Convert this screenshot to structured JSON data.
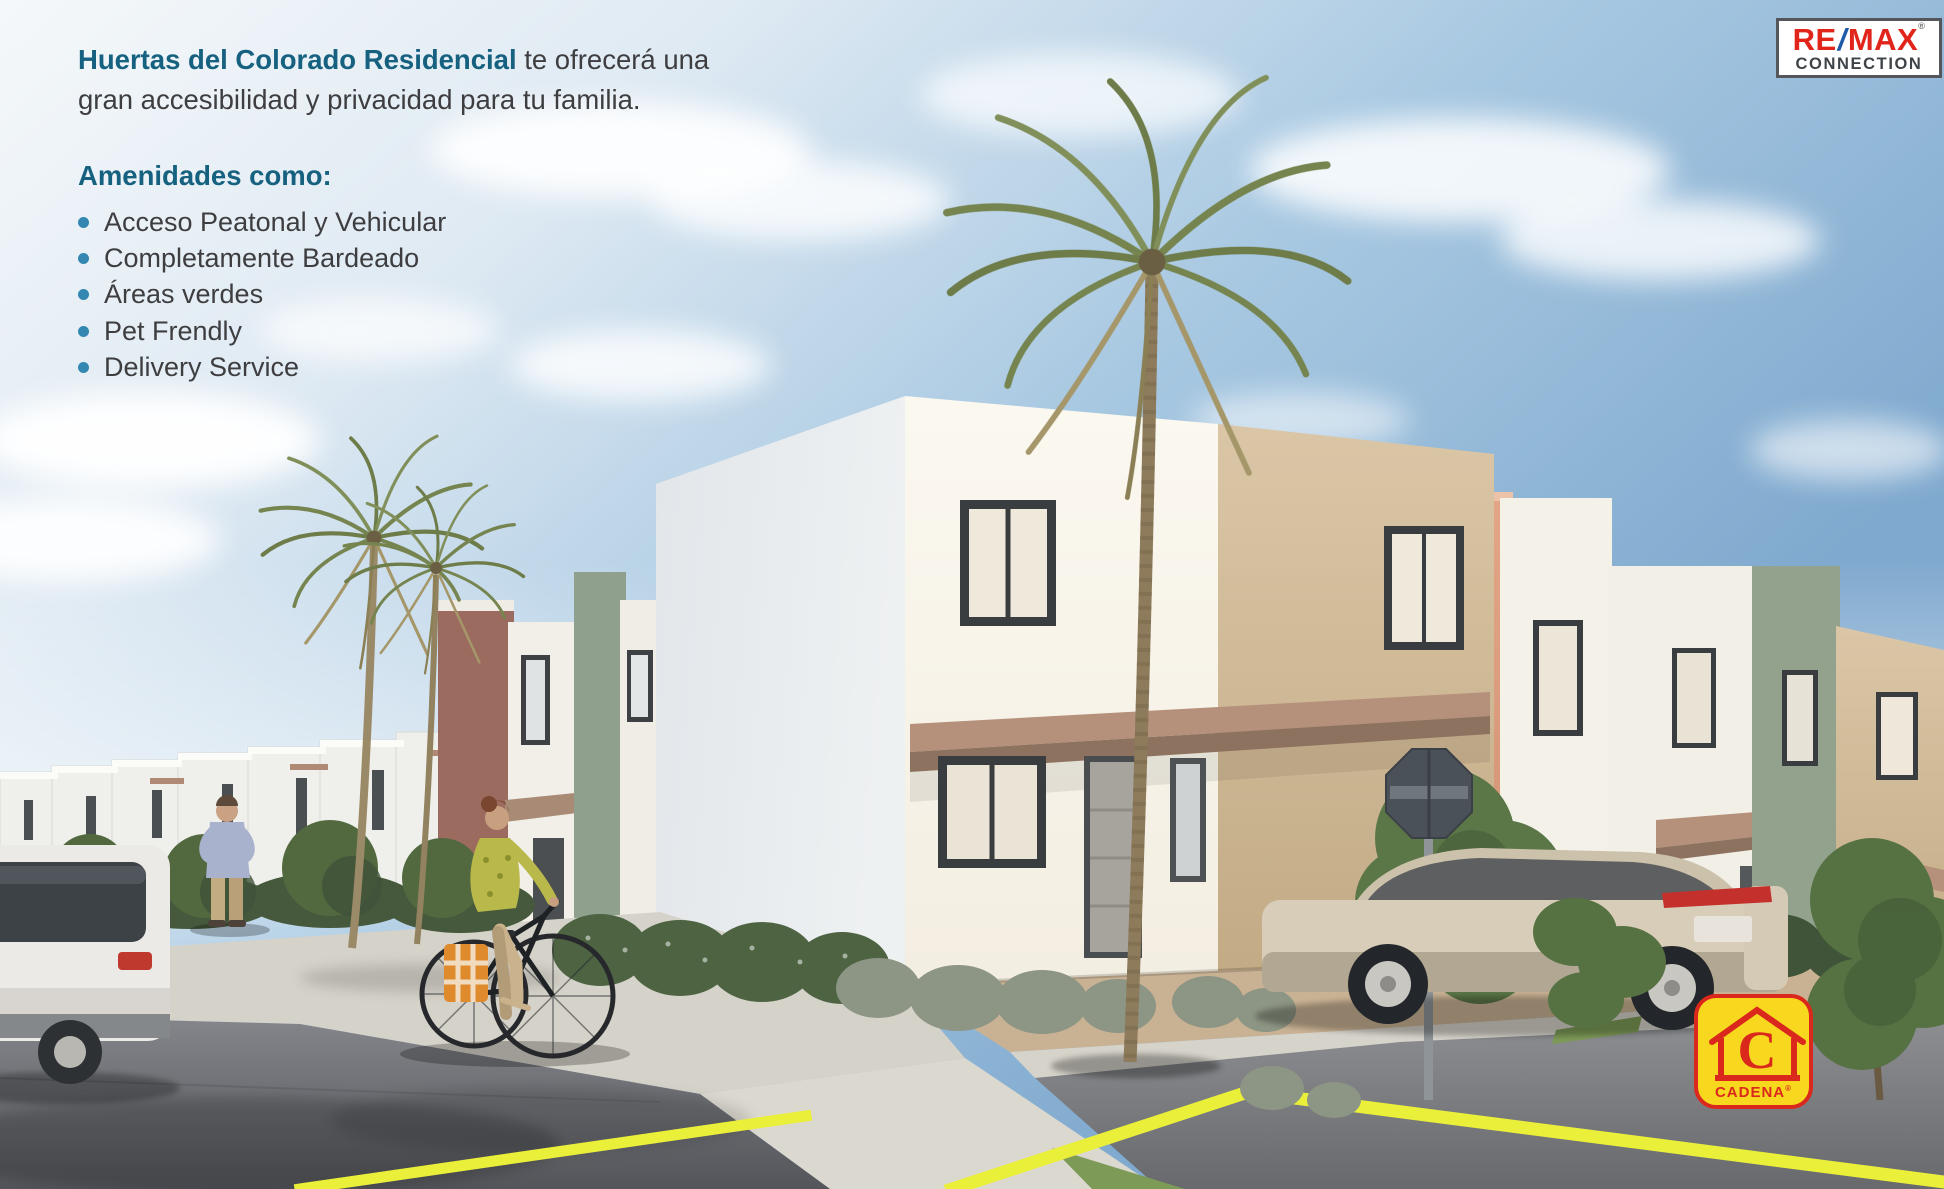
{
  "headline": {
    "brand": "Huertas del Colorado Residencial",
    "rest": "te ofrecerá una gran accesibilidad y privacidad para tu familia."
  },
  "amenities": {
    "title": "Amenidades como:",
    "items": [
      "Acceso Peatonal y Vehicular",
      "Completamente Bardeado",
      "Áreas verdes",
      "Pet Frendly",
      "Delivery Service"
    ]
  },
  "logos": {
    "remax": {
      "re": "RE",
      "slash": "/",
      "max": "MAX",
      "registered": "®",
      "line2": "CONNECTION"
    },
    "cadena": {
      "letter": "C",
      "label": "CADENA",
      "registered": "®"
    }
  },
  "colors": {
    "headline_teal": "#16617F",
    "body_text": "#3E3E41",
    "bullet_blue": "#3387B0",
    "remax_red": "#E1251B",
    "remax_blue": "#1F5AA8",
    "remax_dark": "#3F4449",
    "cadena_yellow": "#F8D81E",
    "cadena_red": "#DA291C",
    "road_marking_yellow": "#EAEF3A",
    "sky_blue": "#7FA9CE"
  }
}
